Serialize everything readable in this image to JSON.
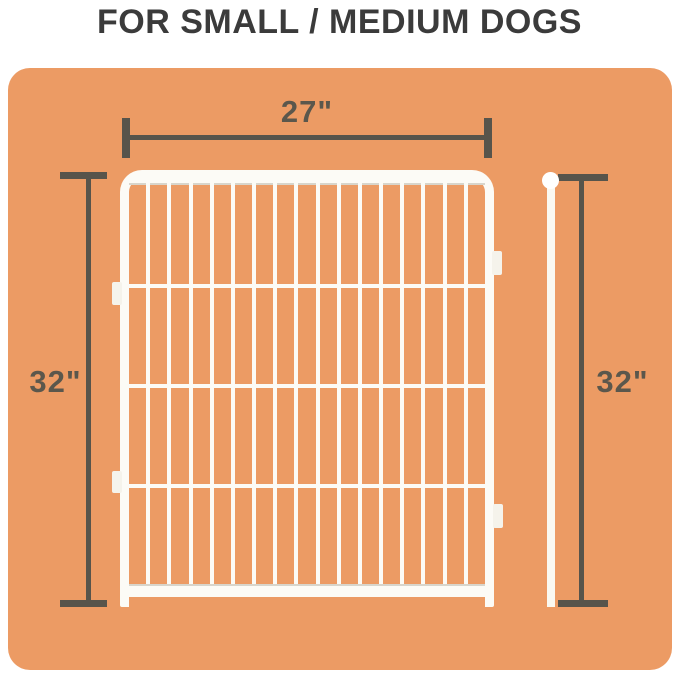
{
  "title": "FOR SMALL / MEDIUM DOGS",
  "dimensions": {
    "top_width": "27\"",
    "left_height": "32\"",
    "right_height": "32\""
  },
  "colors": {
    "page_background": "#FFFFFF",
    "panel_orange": "#EC9B64",
    "dimension_line_gray": "#57544B",
    "dimension_label_gray": "#5B574C",
    "fence_white": "#FCFBF6",
    "fence_shade": "#D8D5CB",
    "title_text": "#3B3B3B"
  },
  "diagram": {
    "subject": "wire-pen-fence-panel-with-connector-pole",
    "vertical_bar_count": 16,
    "horizontal_wire_count": 3,
    "connector_tab_count": 4,
    "pole_style": "vertical-rod-with-ball-top"
  }
}
